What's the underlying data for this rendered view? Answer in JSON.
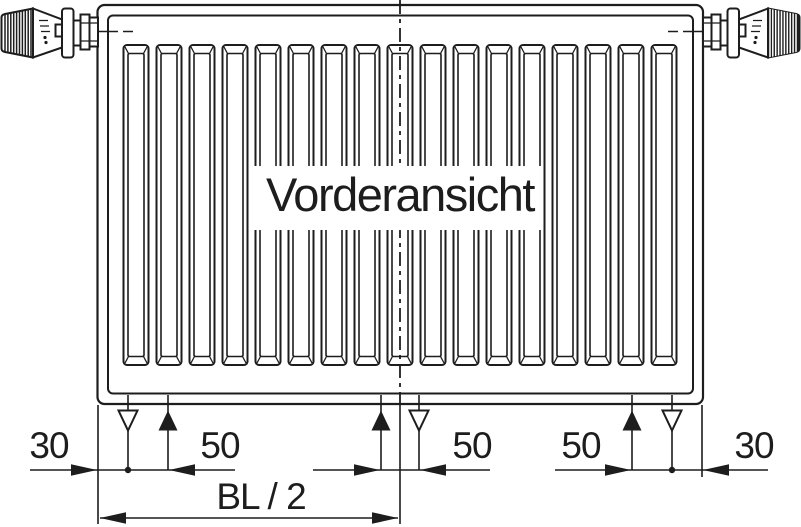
{
  "diagram": {
    "title": "Vorderansicht",
    "dimension_labels": {
      "left_margin": "30",
      "left_bracket_spacing": "50",
      "center_bracket_spacing": "50",
      "right_bracket_spacing": "50",
      "right_margin": "30",
      "half_build_length": "BL / 2"
    },
    "radiator": {
      "rib_count": 17
    },
    "colors": {
      "line": "#1d1d1d",
      "valve_knob_dark": "#1d1d1d",
      "background": "#ffffff"
    }
  }
}
